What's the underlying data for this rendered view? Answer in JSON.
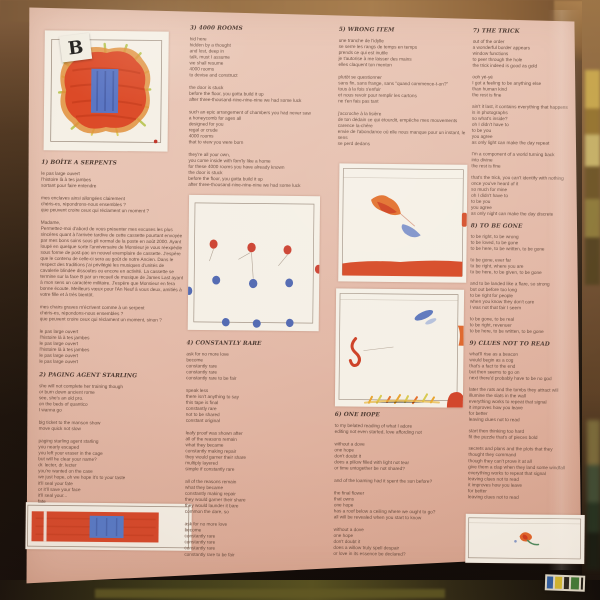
{
  "side_label": "B",
  "colors": {
    "paper": "#e6c0b0",
    "ink": "#6a4e40",
    "heading": "#4e3a31",
    "paint_red": "#d7482a",
    "paint_orange": "#e2702c",
    "paint_blue": "#5a75c3",
    "paint_green": "#b6c24c",
    "pencil": "#a39486"
  },
  "columns": [
    {
      "sections": [
        {
          "heading": "1) BOÎTE A SERPENTS",
          "stanzas": [
            "le pas large ouvert\nl'histoire là à tes jambes\nsortant pour faire entendre",
            "mes enclaves ainsi allongées clairement\nchéris-es, répondrons-nous ensembles ?\nque peuvent croire ceux qui réclament un moment ?",
            "Madame,\nPermettez-moi d'abord de vous présenter mes excuses les plus sincères quant à l'arrivée tardive de cette cassette pourtant envoyée par mes bons soins sous pli normal de la poste en août 2000. Ayant loupé en quelque sorte l'anniversaire de Monsieur je vous réexpédie sous forme de post-pac un nouvel exemplaire de cassette. J'espère que le contenu de celle-ci sera au goût de notre Ancien. Dans le respect des traditions j'ai privilégié les musiques d'unités de cavalerie blindée dissoutes ou encore en activité. La cassette se termine sur la face B par un recueil de musique de James Last ayant à mon sens un caractère militaire. J'espère que Monsieur en fera bonne écoute. Meilleurs vœux pour l'An Neuf à vous deux, amitiés à votre fille et à très bientôt.",
            "mes chairs graves m'écrivent comme à un serpent\nchéris-es, répondons-nous ensembles ?\nque peuvent croire ceux qui réclament un moment, sinon ?",
            "le pas large ouvert\nl'histoire là à tes jambes\nle pas large ouvert\nl'histoire là à tes jambes\nle pas large ouvert\nle pas large ouvert"
          ]
        },
        {
          "heading": "2) PAGING AGENT STARLING",
          "stanzas": [
            "she will not complete her training though\nor burn down ancient rome\nsee, she's an old pro.\non the beds of quantico\nI wanna go",
            "big ticket to the manson show\nmove quick not slow",
            "paging starling agent starling\nyou nearly escaped\nyou left your eraser in the cage\nbut will he clear your name?\ndr. lecter, dr. lecter\nyou're wanted on the case\nwe just hope, oh we hope it's to your taste\nit'll seal your fate\nor it'll save your face\nit'll seal your...\nfate"
          ]
        }
      ]
    },
    {
      "sections": [
        {
          "heading": "3) 4000 ROOMS",
          "stanzas": [
            "hid here\nhidden by a thought\nand lost, deep in\ntalk, must I assume\nwe shall resume\n4000 rooms\nto devise and construct",
            "the door is stuck\nbefore the floor, you gotta build it up\nafter three-thousand-nine-nine-nine we had some luck",
            "such an epic arrangement of chambers you had never saw\na honeycomb for ages all\ndesigned for you\nregal or crude\n4000 rooms\nthat to view you were born",
            "they're all your own,\nyou come inside with fam'ly like a home\nfor these 4000 rooms you have already known\nthe door is stuck\nbefore the floor, you gotta build it up\nafter three-thousand-nine-nine-nine we had some luck"
          ]
        },
        {
          "heading": "4) CONSTANTLY RARE",
          "stanzas": [
            "ask for no more love\nbecome\nconstantly rare\nconstantly rare\nconstantly rare to be fair",
            "speak less\nthere isn't anything to say\nthis tape is final\nconstantly rare\nnot to be shared\nconstant original",
            "leafy proof was shown after\nall of the reasons remain\nwhat they became\nconstantly making repair\nthey would garner their share\nmultiply layered\nsimple if constantly rare",
            "all of the reasons remain\nwhat they became\nconstantly making repair\nthey would garner their share\nthey would launder it bare\ncommon the dare, so",
            "ask for no more love\nbecome\nconstantly rare\nconstantly rare\nconstantly rare\nconstantly rare to be fair"
          ]
        }
      ]
    },
    {
      "sections": [
        {
          "heading": "5) WRONG ITEM",
          "stanzas": [
            "une tranche de l'idylle\nse serre les rangs de temps en temps\nprends ce qui est inutile\nje t'autorise à me laisser des mains\nelles claquent ton menton",
            "plutôt se questionner\nsans fin, sans frange, sans \"quand commence-t-on?\"\ntous à la fois s'enfuir\net nous revoir pour remplir les cartons\nne t'en fais pas tant",
            "j'accroche à la lisière\nde ton dédain ce qui étourdit, empêche mes mouvements\ncarence la-chère\nenvie de l'abondance où elle nous manque pour un instant, le sens\nse perd dedans"
          ]
        },
        {
          "heading": "6) ONE HOPE",
          "stanzas": [
            "to my belated reading of what I adore\nediting not even started, love affording not",
            "without a dove\none hope\ndon't doubt it\ndoes a pillow filled with light not tear\nor time untogether be not shared?",
            "and of the loaming had it spent the sun before?",
            "the final flower\nthat owns\none hope\nhas a roof below a ceiling where we ought to go?\nall will be revealed when you start to know",
            "without a dove\none hope\ndon't doubt it\ndoes a willow truly spell despair\nor love in its essence be declared?"
          ]
        }
      ]
    },
    {
      "sections": [
        {
          "heading": "7) THE TRICK",
          "stanzas": [
            "out of the order\na wonderful border appears\nwindow functions\nto peer through the hole\nthe trick indeed is good as gold",
            "ooh yé-yé\nI got a feeling to be anything else\nthan human kind\nthe rest is fine",
            "ain't it last, it contains everything that happens\nis in photographs\nso what's inside?\noh I didn't have to\nto be you\nyou agree\nas only light can make the day repeat",
            "I'm a component of a world turning back\ninto divine\nthe rest is fine",
            "that's the trick, you can't identify with nothing\nonce you've heard of it\nso much for mine\noh I didn't have to\nto be you\nyou agree\nas only night can make the day discrete"
          ]
        },
        {
          "heading": "8) TO BE GONE",
          "stanzas": [
            "to be right, to be wrong\nto be loved, to be gone\nto be here, to be written, to be gone",
            "to be gone, ever far\nto be right, where you are\nto be here, to be given, to be gone",
            "and to be landed like a flare, so strong\nbut out before too long\nto be right for people\nwhen you know they don't care\nI was not that fair I seem",
            "to be gone, to be real\nto be right, revenuer\nto be here, to be written, to be gone"
          ]
        },
        {
          "heading": "9) CLUES NOT TO READ",
          "stanzas": [
            "what'll rise as a beacon\nwould begin as a cog\nthat's a fact to the end\nbut then seems to go on\nnext there'd probably have to be no god",
            "later the rats and the tombs they attract will\nillumine the slats in the wall\neverything works to repeat that signal\nit improves how you leave\nfor better\nleaving clues not to read",
            "start then thinking too hard\nfit the puzzle that's of pieces bold",
            "secrets and plans and the plots that they\nthought they command\nthough they can't prove it at all\ngive them a clap when they land some windfall\neverything works to repeat that signal\nleaving clues not to read\nit improves how you leave\nfor better\nleaving clues not to read"
          ]
        }
      ]
    }
  ]
}
